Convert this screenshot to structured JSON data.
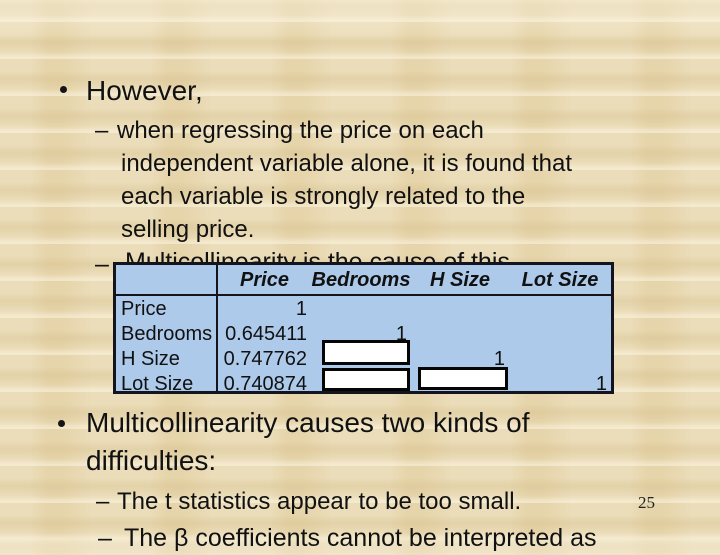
{
  "slide": {
    "colors": {
      "background": "#E9D9B1",
      "text": "#111111",
      "table_fill": "#ADCAEA",
      "table_border": "#14141E",
      "mask_fill": "#FFFFFF",
      "mask_border": "#000000"
    },
    "bullets": {
      "however": {
        "label": "However,"
      },
      "regressing": {
        "marker": "–",
        "lines": [
          "when regressing the price on each",
          "independent variable alone, it is found that",
          "each variable is strongly related to the",
          "selling price."
        ]
      },
      "hidden": {
        "marker": "–",
        "text": "Multicollinearity is the cause of this"
      },
      "causes": {
        "lines": [
          "Multicollinearity causes two kinds of",
          "difficulties:"
        ]
      },
      "t_stats": {
        "marker": "–",
        "text": "The t statistics appear to be too small."
      },
      "beta": {
        "marker": "–",
        "text": "The β coefficients cannot be interpreted as"
      }
    },
    "page_number": "25"
  },
  "table": {
    "columns": [
      "",
      "Price",
      "Bedrooms",
      "H Size",
      "Lot Size"
    ],
    "rows": [
      {
        "label": "Price",
        "price": "1",
        "bedrooms": "",
        "h_size": "",
        "lot_size": ""
      },
      {
        "label": "Bedrooms",
        "price": "0.645411",
        "bedrooms": "1",
        "h_size": "",
        "lot_size": ""
      },
      {
        "label": "H Size",
        "price": "0.747762",
        "bedrooms": "",
        "h_size": "1",
        "lot_size": ""
      },
      {
        "label": "Lot Size",
        "price": "0.740874",
        "bedrooms": "",
        "h_size": "",
        "lot_size": "1"
      }
    ],
    "masks": [
      {
        "row": "H Size",
        "column": "Bedrooms"
      },
      {
        "row": "Lot Size",
        "column": "Bedrooms"
      },
      {
        "row": "Lot Size",
        "column": "H Size"
      }
    ]
  }
}
